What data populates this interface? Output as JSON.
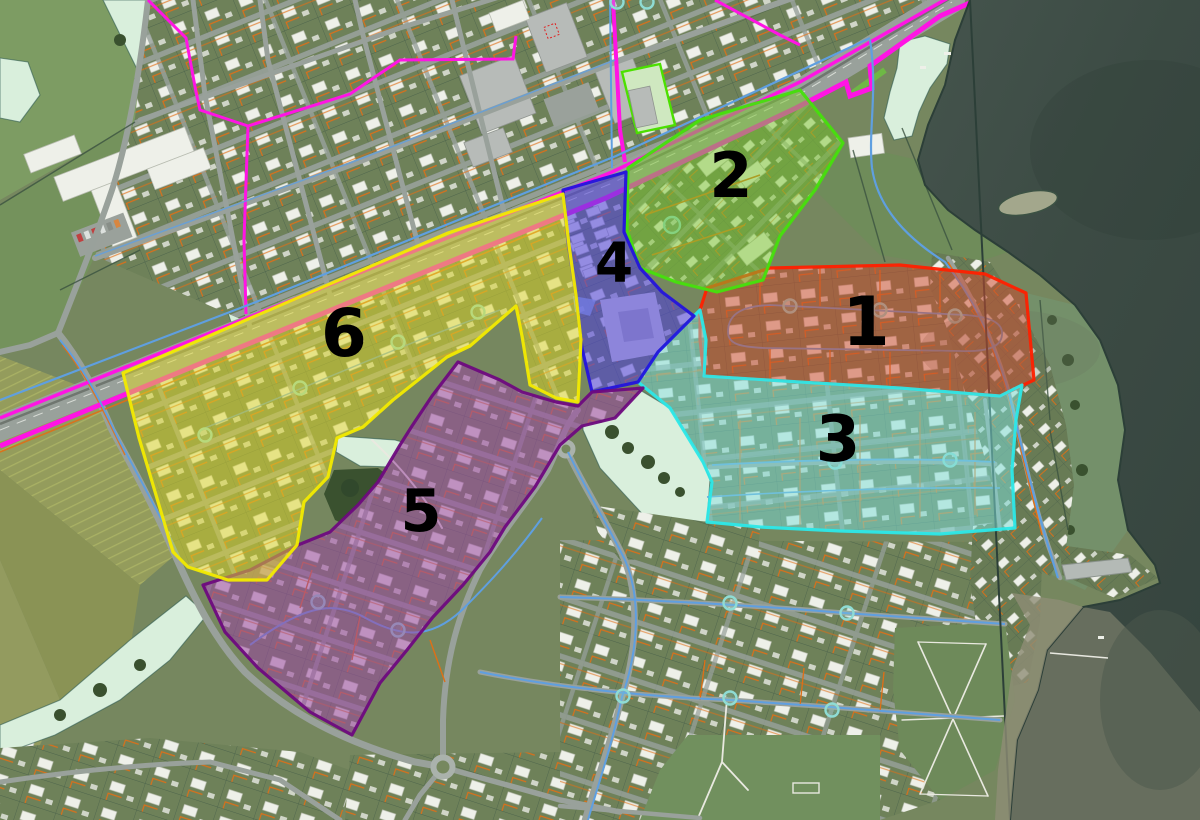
{
  "map": {
    "zones": [
      {
        "id": "zone-1",
        "label": "1",
        "fill": "#cf4a30",
        "stroke": "#ff2000",
        "label_x": 866,
        "label_y": 345,
        "font_size": 68
      },
      {
        "id": "zone-2",
        "label": "2",
        "fill": "#7cc832",
        "stroke": "#46e00c",
        "label_x": 731,
        "label_y": 197,
        "font_size": 62
      },
      {
        "id": "zone-3",
        "label": "3",
        "fill": "#7fdfd8",
        "stroke": "#2ce8e8",
        "label_x": 838,
        "label_y": 461,
        "font_size": 64
      },
      {
        "id": "zone-4",
        "label": "4",
        "fill": "#5244dc",
        "stroke": "#2414dc",
        "label_x": 614,
        "label_y": 282,
        "font_size": 55
      },
      {
        "id": "zone-5",
        "label": "5",
        "fill": "#9c4ba2",
        "stroke": "#6e0a7e",
        "label_x": 421,
        "label_y": 531,
        "font_size": 59
      },
      {
        "id": "zone-6",
        "label": "6",
        "fill": "#dfd72b",
        "stroke": "#f2ea00",
        "label_x": 344,
        "label_y": 356,
        "font_size": 66
      }
    ],
    "palette": {
      "land": "#76875f",
      "field_bright": "#7d9c63",
      "mint": "#d9efdc",
      "sea_deep": "#36453f",
      "sea_mid": "#49584f",
      "shallow": "#6d7262",
      "road": "#98a19b",
      "magenta_line": "#ff14e4",
      "orange_line": "#df6f16",
      "blue_line": "#5f9fe0",
      "teal_node": "#8fdcd4",
      "stream": "#2e5a50",
      "white_building": "#eef0e9"
    }
  }
}
